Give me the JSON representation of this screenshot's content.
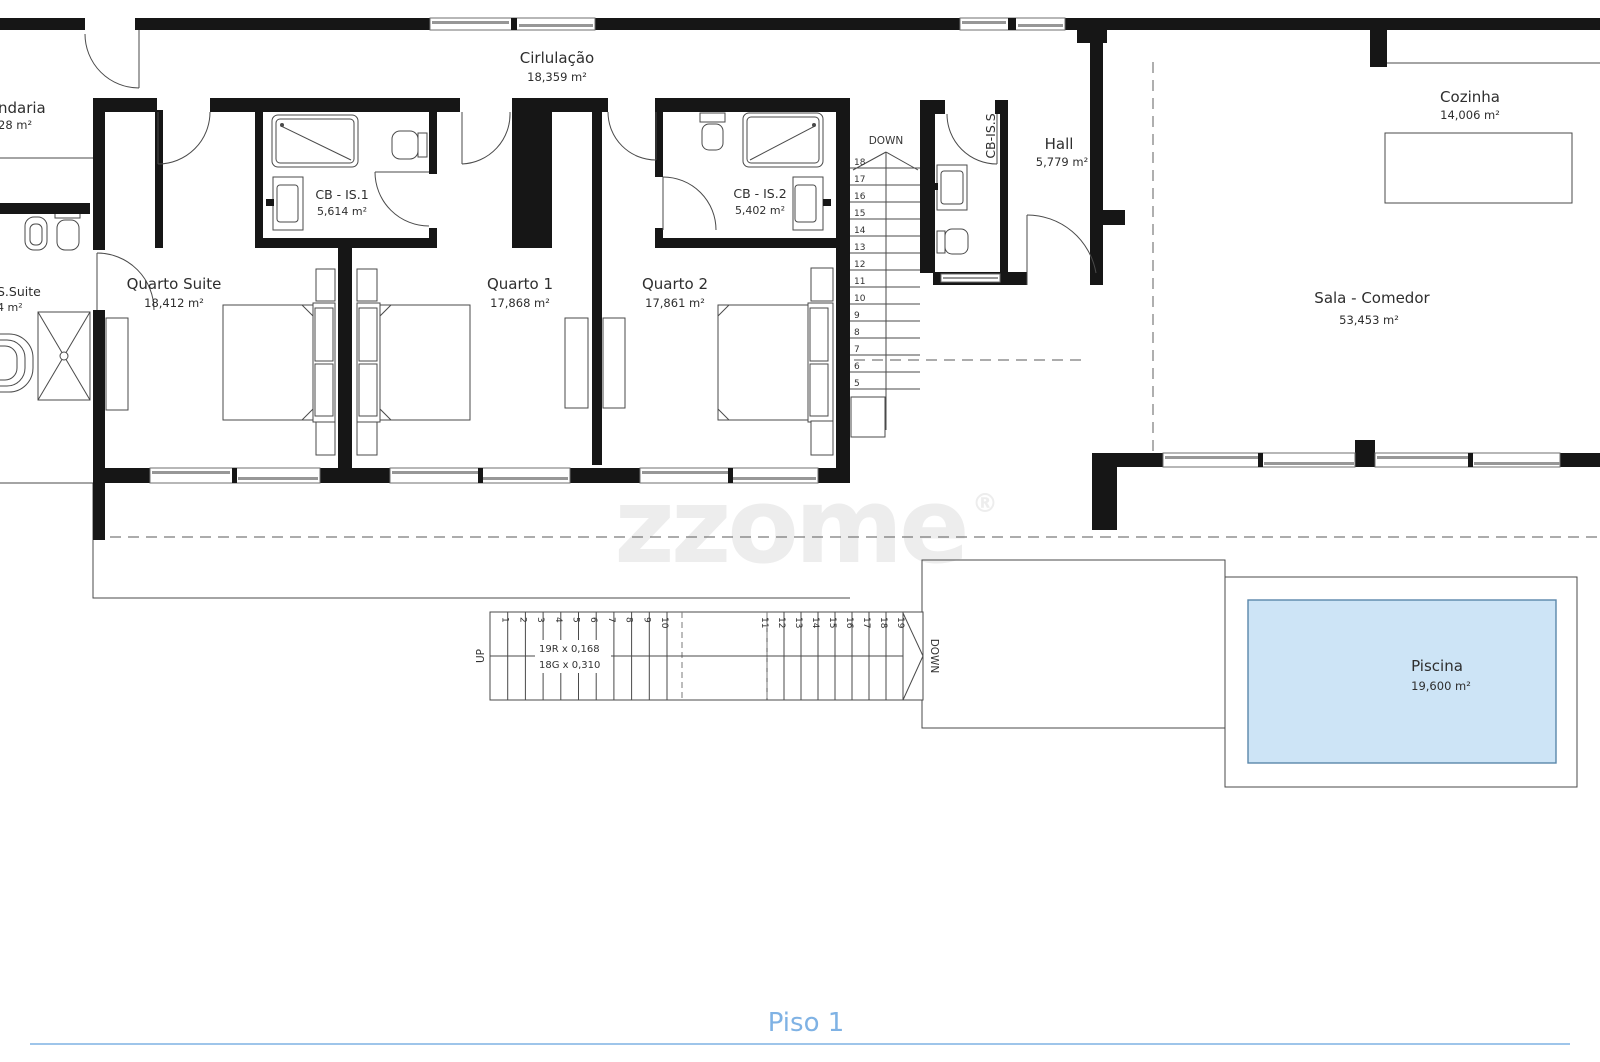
{
  "floor": {
    "title": "Piso 1"
  },
  "watermark": {
    "text": "zzome",
    "reg": "®"
  },
  "colors": {
    "pool_fill": "#cde4f6",
    "pool_stroke": "#5a87aa",
    "accent_blue": "#7fb2e4",
    "wall": "#161616"
  },
  "rooms": {
    "cirlulacao": {
      "name": "Cirlulação",
      "area": "18,359 m²"
    },
    "quarto_suite": {
      "name": "Quarto Suite",
      "area": "18,412 m²"
    },
    "cb_is1": {
      "name": "CB - IS.1",
      "area": "5,614 m²"
    },
    "quarto1": {
      "name": "Quarto 1",
      "area": "17,868 m²"
    },
    "quarto2": {
      "name": "Quarto 2",
      "area": "17,861 m²"
    },
    "cb_is2": {
      "name": "CB - IS.2",
      "area": "5,402 m²"
    },
    "cb_iss": {
      "name": "CB-IS.S"
    },
    "hall": {
      "name": "Hall",
      "area": "5,779 m²"
    },
    "cozinha": {
      "name": "Cozinha",
      "area": "14,006 m²"
    },
    "sala": {
      "name": "Sala - Comedor",
      "area": "53,453 m²"
    },
    "piscina": {
      "name": "Piscina",
      "area": "19,600 m²"
    },
    "lavandaria_partial": {
      "name": "ndaria",
      "area": "28 m²"
    },
    "cb_is_suite_partial": {
      "name": "S.Suite",
      "area": "4 m²"
    }
  },
  "stairs_upper": {
    "label": "DOWN",
    "numbers": [
      18,
      17,
      16,
      15,
      14,
      13,
      12,
      11,
      10,
      9,
      8,
      7,
      6,
      5
    ]
  },
  "stairs_lower": {
    "up_label": "UP",
    "down_label": "DOWN",
    "spec_risers": "19R x 0,168",
    "spec_goings": "18G x 0,310",
    "numbers": [
      1,
      2,
      3,
      4,
      5,
      6,
      7,
      8,
      9,
      10,
      11,
      12,
      13,
      14,
      15,
      16,
      17,
      18,
      19
    ]
  }
}
